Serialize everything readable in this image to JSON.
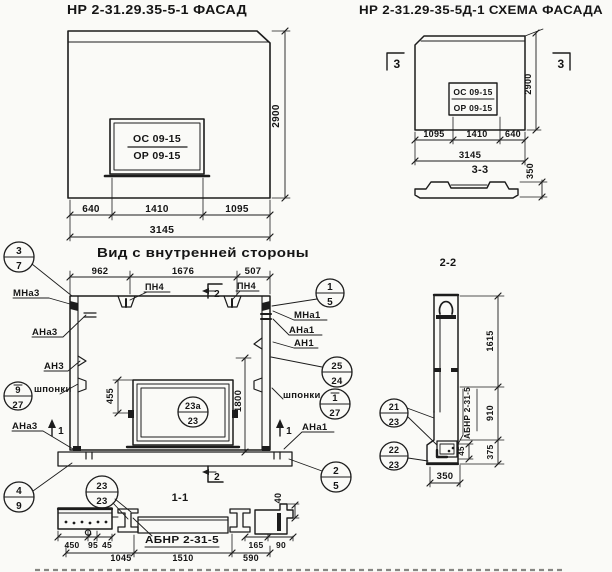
{
  "paper_color": "#fafaf7",
  "ink_color": "#1c1c1c",
  "facade": {
    "title": "НР 2-31.29.35-5-1 ФАСАД",
    "win_top": "ОС 09-15",
    "win_bot": "ОР 09-15",
    "d640": "640",
    "d1410": "1410",
    "d1095": "1095",
    "d3145": "3145",
    "h2900": "2900"
  },
  "schema": {
    "title": "НР 2-31.29-35-5Д-1 СХЕМА ФАСАДА",
    "win_top": "ОС 09-15",
    "win_bot": "ОР 09-15",
    "marker_left": "3",
    "marker_right": "3",
    "d1095": "1095",
    "d1410": "1410",
    "d640": "640",
    "d3145": "3145",
    "h2900": "2900",
    "s33_title": "3-3",
    "s33_thk": "350"
  },
  "interior": {
    "title": "Вид с внутренней стороны",
    "d962": "962",
    "d1676": "1676",
    "d507": "507",
    "d455": "455",
    "d1800": "1800",
    "pn4_left": "ПН4",
    "pn4_right": "ПН4",
    "marker2_top": "2",
    "marker2_bottom": "2",
    "marker1_left": "1",
    "marker1_right": "1",
    "mna3": "МНа3",
    "ana3": "АНа3",
    "an3": "АН3",
    "shponki_left": "шпонки",
    "ana3b": "АНа3",
    "mna1": "МНа1",
    "ana1": "АНа1",
    "an1": "АН1",
    "shponki_right": "шпонки",
    "ana1b": "АНа1",
    "c37": {
      "top": "3",
      "bot": "7"
    },
    "c927": {
      "top": "9",
      "bot": "27"
    },
    "c49": {
      "top": "4",
      "bot": "9"
    },
    "c15": {
      "top": "1",
      "bot": "5"
    },
    "c2524": {
      "top": "25",
      "bot": "24"
    },
    "c127": {
      "top": "1",
      "bot": "27"
    },
    "c25": {
      "top": "2",
      "bot": "5"
    },
    "c23a": {
      "top": "23а",
      "bot": "23"
    }
  },
  "sec11": {
    "title": "1-1",
    "c2323": {
      "top": "23",
      "bot": "23"
    },
    "label": "АБНР 2-31-5",
    "d450": "450",
    "d95": "95",
    "d45": "45",
    "d1045": "1045",
    "d1510": "1510",
    "d590": "590",
    "d165": "165",
    "d90": "90",
    "d40": "40"
  },
  "sec22": {
    "title": "2-2",
    "c2123": {
      "top": "21",
      "bot": "23"
    },
    "c2223": {
      "top": "22",
      "bot": "23"
    },
    "label": "АБНР 2-31-5",
    "d1615": "1615",
    "d910": "910",
    "d375": "375",
    "d45": "45",
    "d350": "350"
  }
}
